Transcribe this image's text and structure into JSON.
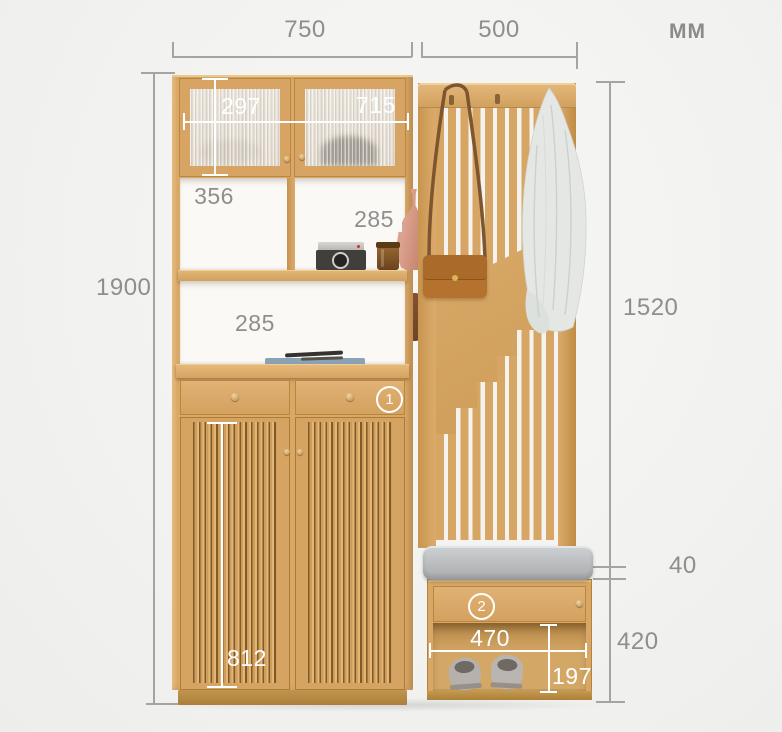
{
  "units": {
    "label": "MM"
  },
  "dims": {
    "cabinet_width": "750",
    "rack_width": "500",
    "total_height": "1900",
    "rack_height": "1520",
    "glass_door_height": "297",
    "upper_cabinet_width": "715",
    "shelf_width": "356",
    "upper_niche_height": "285",
    "middle_niche_height": "285",
    "door_height": "812",
    "cushion_thickness": "40",
    "bench_height": "420",
    "bench_width": "470",
    "shoe_shelf_height": "197"
  },
  "markers": {
    "cabinet_drawer": "1",
    "bench_drawer": "2"
  },
  "colors": {
    "wood": "#d9a766",
    "wood_dark": "#8a6228",
    "background": "#f1f1ef",
    "dim_line": "#a4a4a2",
    "dim_text": "#8e8e8c",
    "dim_text_on_wood": "#ffffff",
    "cushion": "#b9bbbd"
  },
  "decor": {
    "vase": "terracotta-vase",
    "camera": "vintage-camera",
    "jar": "amber-jar",
    "book": "book-with-pens",
    "bag": "leather-crossbody-bag",
    "shirt": "hanging-shirt",
    "slippers": "gray-slippers",
    "pouch": "hanging-pouch"
  }
}
